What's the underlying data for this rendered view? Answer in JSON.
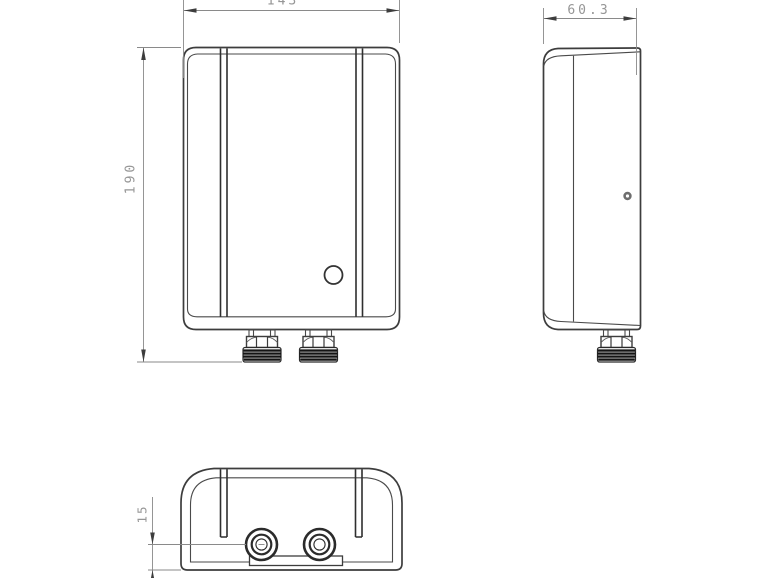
{
  "drawing": {
    "type": "orthographic-technical-drawing",
    "dimensions": {
      "front_width_top": "143",
      "front_height": "190",
      "side_depth": "60.3",
      "port_to_bottom": "15"
    },
    "colors": {
      "outline": "#3d3d3d",
      "dimension_line": "#8a8a8a",
      "dimension_text": "#969696",
      "thread_fill": "#141414"
    }
  }
}
